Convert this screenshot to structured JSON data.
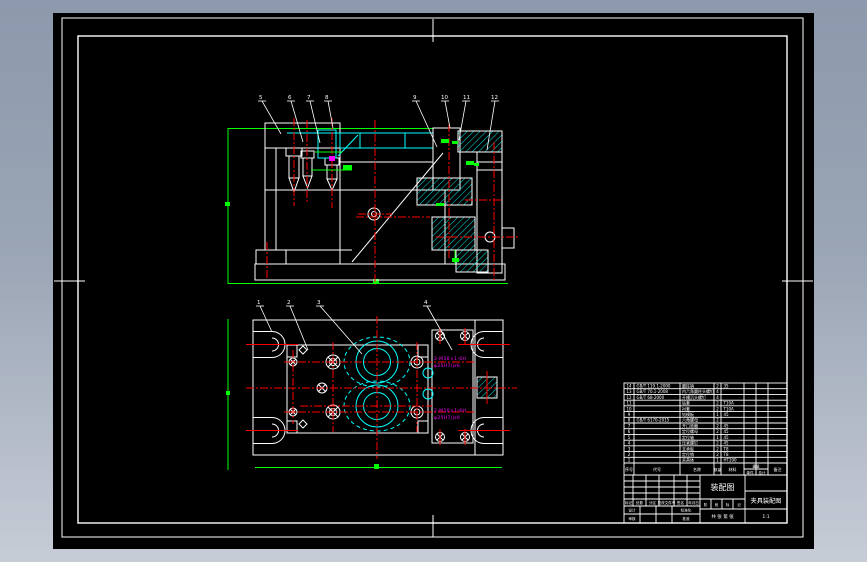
{
  "colors": {
    "page_top": "#8d99ac",
    "page_bottom": "#c7ccd6",
    "canvas": "#000000",
    "frame": "#ffffff",
    "outline": "#ffffff",
    "hatch_cyan": "#00ffff",
    "centerline_red": "#ff0000",
    "dimension_green": "#00ff00",
    "callout_magenta": "#ff00ff"
  },
  "balloons": {
    "plan": [
      "1",
      "2",
      "3",
      "4"
    ],
    "section": [
      "5",
      "6",
      "7",
      "8",
      "9",
      "10",
      "11",
      "12"
    ]
  },
  "callouts": {
    "a1": "2-M10×1-6H",
    "a2": "φ25H7/js6",
    "b1": "2-M10×1-6H",
    "b2": "φ25H7/js6"
  },
  "bom": {
    "headers": {
      "no": "序号",
      "code": "代号",
      "name": "名称",
      "qty": "数量",
      "mat": "材料",
      "weight": "重量",
      "single": "单件",
      "total": "总计",
      "remark": "备注"
    },
    "rows": [
      {
        "no": "14",
        "code": "GB/T 119.1-2000",
        "name": "圆柱销",
        "qty": "2",
        "mat": "35"
      },
      {
        "no": "13",
        "code": "GB/T 70.1-2008",
        "name": "内六角圆柱头螺钉",
        "qty": "4",
        "mat": ""
      },
      {
        "no": "12",
        "code": "GB/T 68-2000",
        "name": "开槽沉头螺钉",
        "qty": "4",
        "mat": ""
      },
      {
        "no": "11",
        "code": "",
        "name": "钻套",
        "qty": "2",
        "mat": "T10A"
      },
      {
        "no": "10",
        "code": "",
        "name": "衬套",
        "qty": "2",
        "mat": "T10A"
      },
      {
        "no": "9",
        "code": "",
        "name": "钻模板",
        "qty": "1",
        "mat": "45"
      },
      {
        "no": "8",
        "code": "GB/T 6170-2015",
        "name": "六角螺母",
        "qty": "2",
        "mat": ""
      },
      {
        "no": "7",
        "code": "",
        "name": "开口垫圈",
        "qty": "2",
        "mat": "45"
      },
      {
        "no": "6",
        "code": "",
        "name": "定位螺母",
        "qty": "2",
        "mat": "45"
      },
      {
        "no": "5",
        "code": "",
        "name": "定位轴",
        "qty": "1",
        "mat": "45"
      },
      {
        "no": "4",
        "code": "",
        "name": "压紧螺钉",
        "qty": "2",
        "mat": "45"
      },
      {
        "no": "3",
        "code": "",
        "name": "支承板",
        "qty": "2",
        "mat": "T8"
      },
      {
        "no": "2",
        "code": "",
        "name": "定位销",
        "qty": "2",
        "mat": "T8"
      },
      {
        "no": "1",
        "code": "",
        "name": "夹具体",
        "qty": "1",
        "mat": "HT200"
      }
    ]
  },
  "title_block": {
    "drawing_name": "装配图",
    "project_name": "夹具装配图",
    "stage_cells": [
      "阶",
      "段",
      "标",
      "记"
    ],
    "sheet_text": "共 张 第 张",
    "scale_text": "1:1",
    "rev_headers": [
      "标记",
      "处数",
      "分区",
      "更改文件号",
      "签名",
      "年月日"
    ],
    "role_row1_left": "设计",
    "role_row1_right": "标准化",
    "role_row2_left": "审核",
    "role_row2_right": "批准"
  }
}
